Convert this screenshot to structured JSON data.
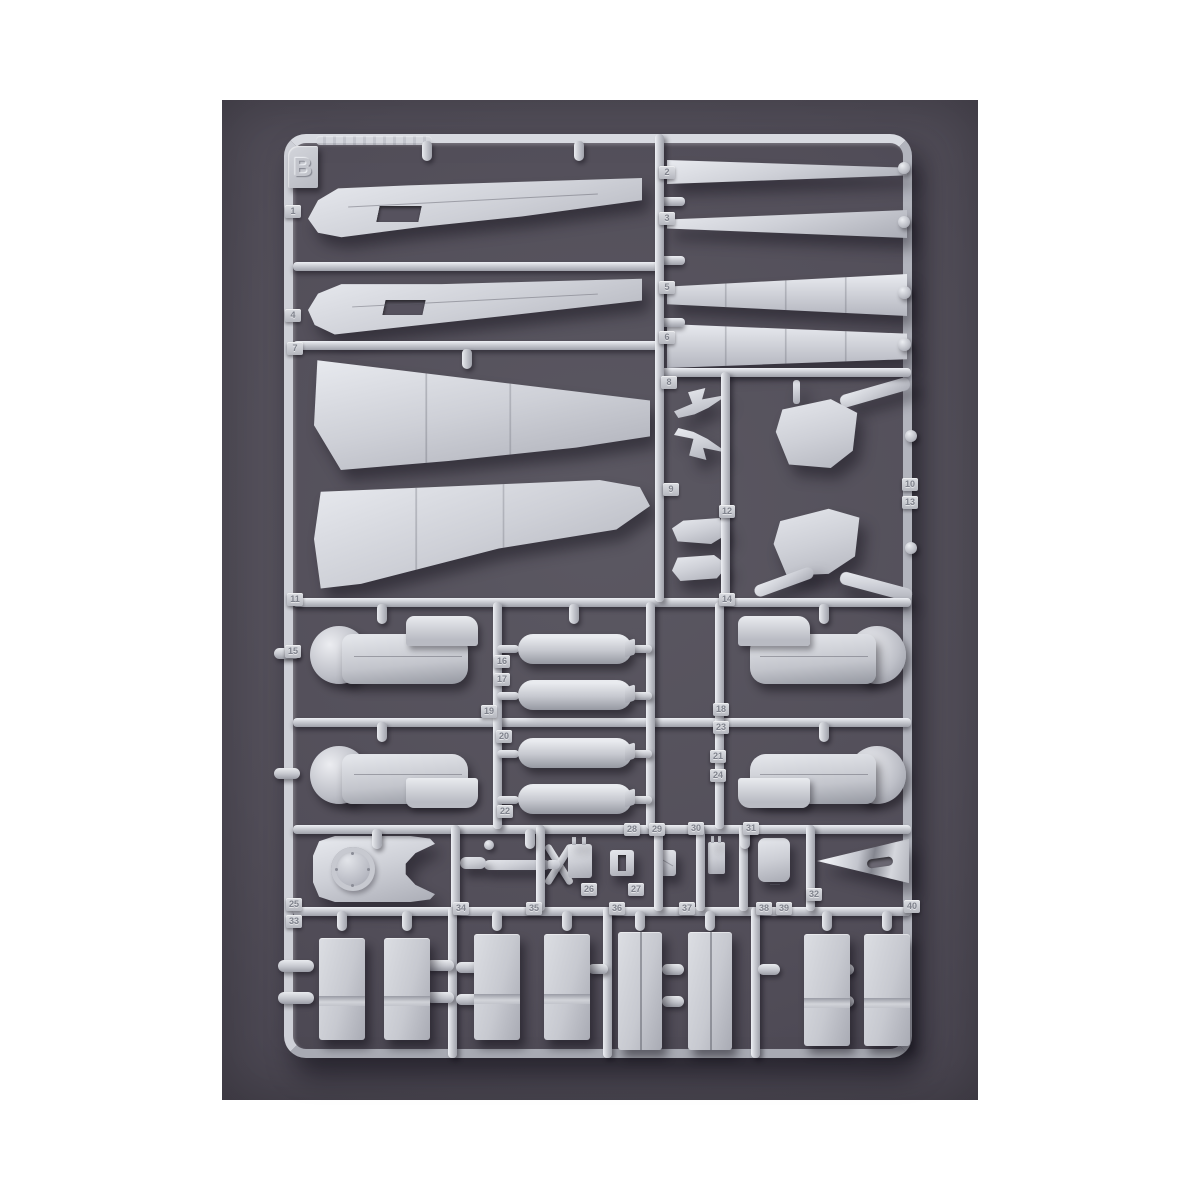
{
  "sprue": {
    "letter": "B",
    "part_tags": [
      {
        "id": "tag-1",
        "label": "1"
      },
      {
        "id": "tag-2",
        "label": "2"
      },
      {
        "id": "tag-3",
        "label": "3"
      },
      {
        "id": "tag-4",
        "label": "4"
      },
      {
        "id": "tag-5",
        "label": "5"
      },
      {
        "id": "tag-6",
        "label": "6"
      },
      {
        "id": "tag-7",
        "label": "7"
      },
      {
        "id": "tag-8",
        "label": "8"
      },
      {
        "id": "tag-9",
        "label": "9"
      },
      {
        "id": "tag-10",
        "label": "10"
      },
      {
        "id": "tag-11",
        "label": "11"
      },
      {
        "id": "tag-12",
        "label": "12"
      },
      {
        "id": "tag-13",
        "label": "13"
      },
      {
        "id": "tag-14",
        "label": "14"
      },
      {
        "id": "tag-15",
        "label": "15"
      },
      {
        "id": "tag-16",
        "label": "16"
      },
      {
        "id": "tag-17",
        "label": "17"
      },
      {
        "id": "tag-18",
        "label": "18"
      },
      {
        "id": "tag-19",
        "label": "19"
      },
      {
        "id": "tag-20",
        "label": "20"
      },
      {
        "id": "tag-21",
        "label": "21"
      },
      {
        "id": "tag-22",
        "label": "22"
      },
      {
        "id": "tag-23",
        "label": "23"
      },
      {
        "id": "tag-24",
        "label": "24"
      },
      {
        "id": "tag-25",
        "label": "25"
      },
      {
        "id": "tag-26",
        "label": "26"
      },
      {
        "id": "tag-27",
        "label": "27"
      },
      {
        "id": "tag-28",
        "label": "28"
      },
      {
        "id": "tag-29",
        "label": "29"
      },
      {
        "id": "tag-30",
        "label": "30"
      },
      {
        "id": "tag-31",
        "label": "31"
      },
      {
        "id": "tag-32",
        "label": "32"
      },
      {
        "id": "tag-33",
        "label": "33"
      },
      {
        "id": "tag-34",
        "label": "34"
      },
      {
        "id": "tag-35",
        "label": "35"
      },
      {
        "id": "tag-36",
        "label": "36"
      },
      {
        "id": "tag-37",
        "label": "37"
      },
      {
        "id": "tag-38",
        "label": "38"
      },
      {
        "id": "tag-39",
        "label": "39"
      },
      {
        "id": "tag-40",
        "label": "40"
      }
    ],
    "molded_parts": [
      "tail-fin-half-a",
      "tail-fin-half-b",
      "outer-wing-panel-a",
      "outer-wing-panel-b",
      "leading-edge-strip-a",
      "leading-edge-strip-b",
      "flap-strip-a",
      "flap-strip-b",
      "folded-arrow-bracket-a",
      "folded-arrow-bracket-b",
      "hinge-plate-a",
      "hinge-plate-b",
      "wing-center-section-a",
      "wing-center-section-b",
      "engine-nacelle-half-1",
      "engine-nacelle-half-2",
      "engine-nacelle-half-3",
      "engine-nacelle-half-4",
      "drop-tank-half-1",
      "drop-tank-half-2",
      "drop-tank-half-3",
      "drop-tank-half-4",
      "engine-cowling-ring",
      "propeller-assembly",
      "equipment-box-a",
      "equipment-box-b",
      "hatch-plate",
      "access-door",
      "nose-cone",
      "landing-gear-door-1",
      "landing-gear-door-2",
      "landing-gear-door-3",
      "landing-gear-door-4",
      "landing-gear-door-5",
      "landing-gear-door-6",
      "landing-gear-door-7",
      "landing-gear-door-8"
    ]
  },
  "colors": {
    "canvas_background": "#ffffff",
    "backdrop": "#524e59",
    "backdrop_edge": "#3c3844",
    "plastic": "#c9cbd2",
    "plastic_highlight": "#eceef2",
    "plastic_shadow": "#9b9da6",
    "tag_text": "#7f828c"
  }
}
